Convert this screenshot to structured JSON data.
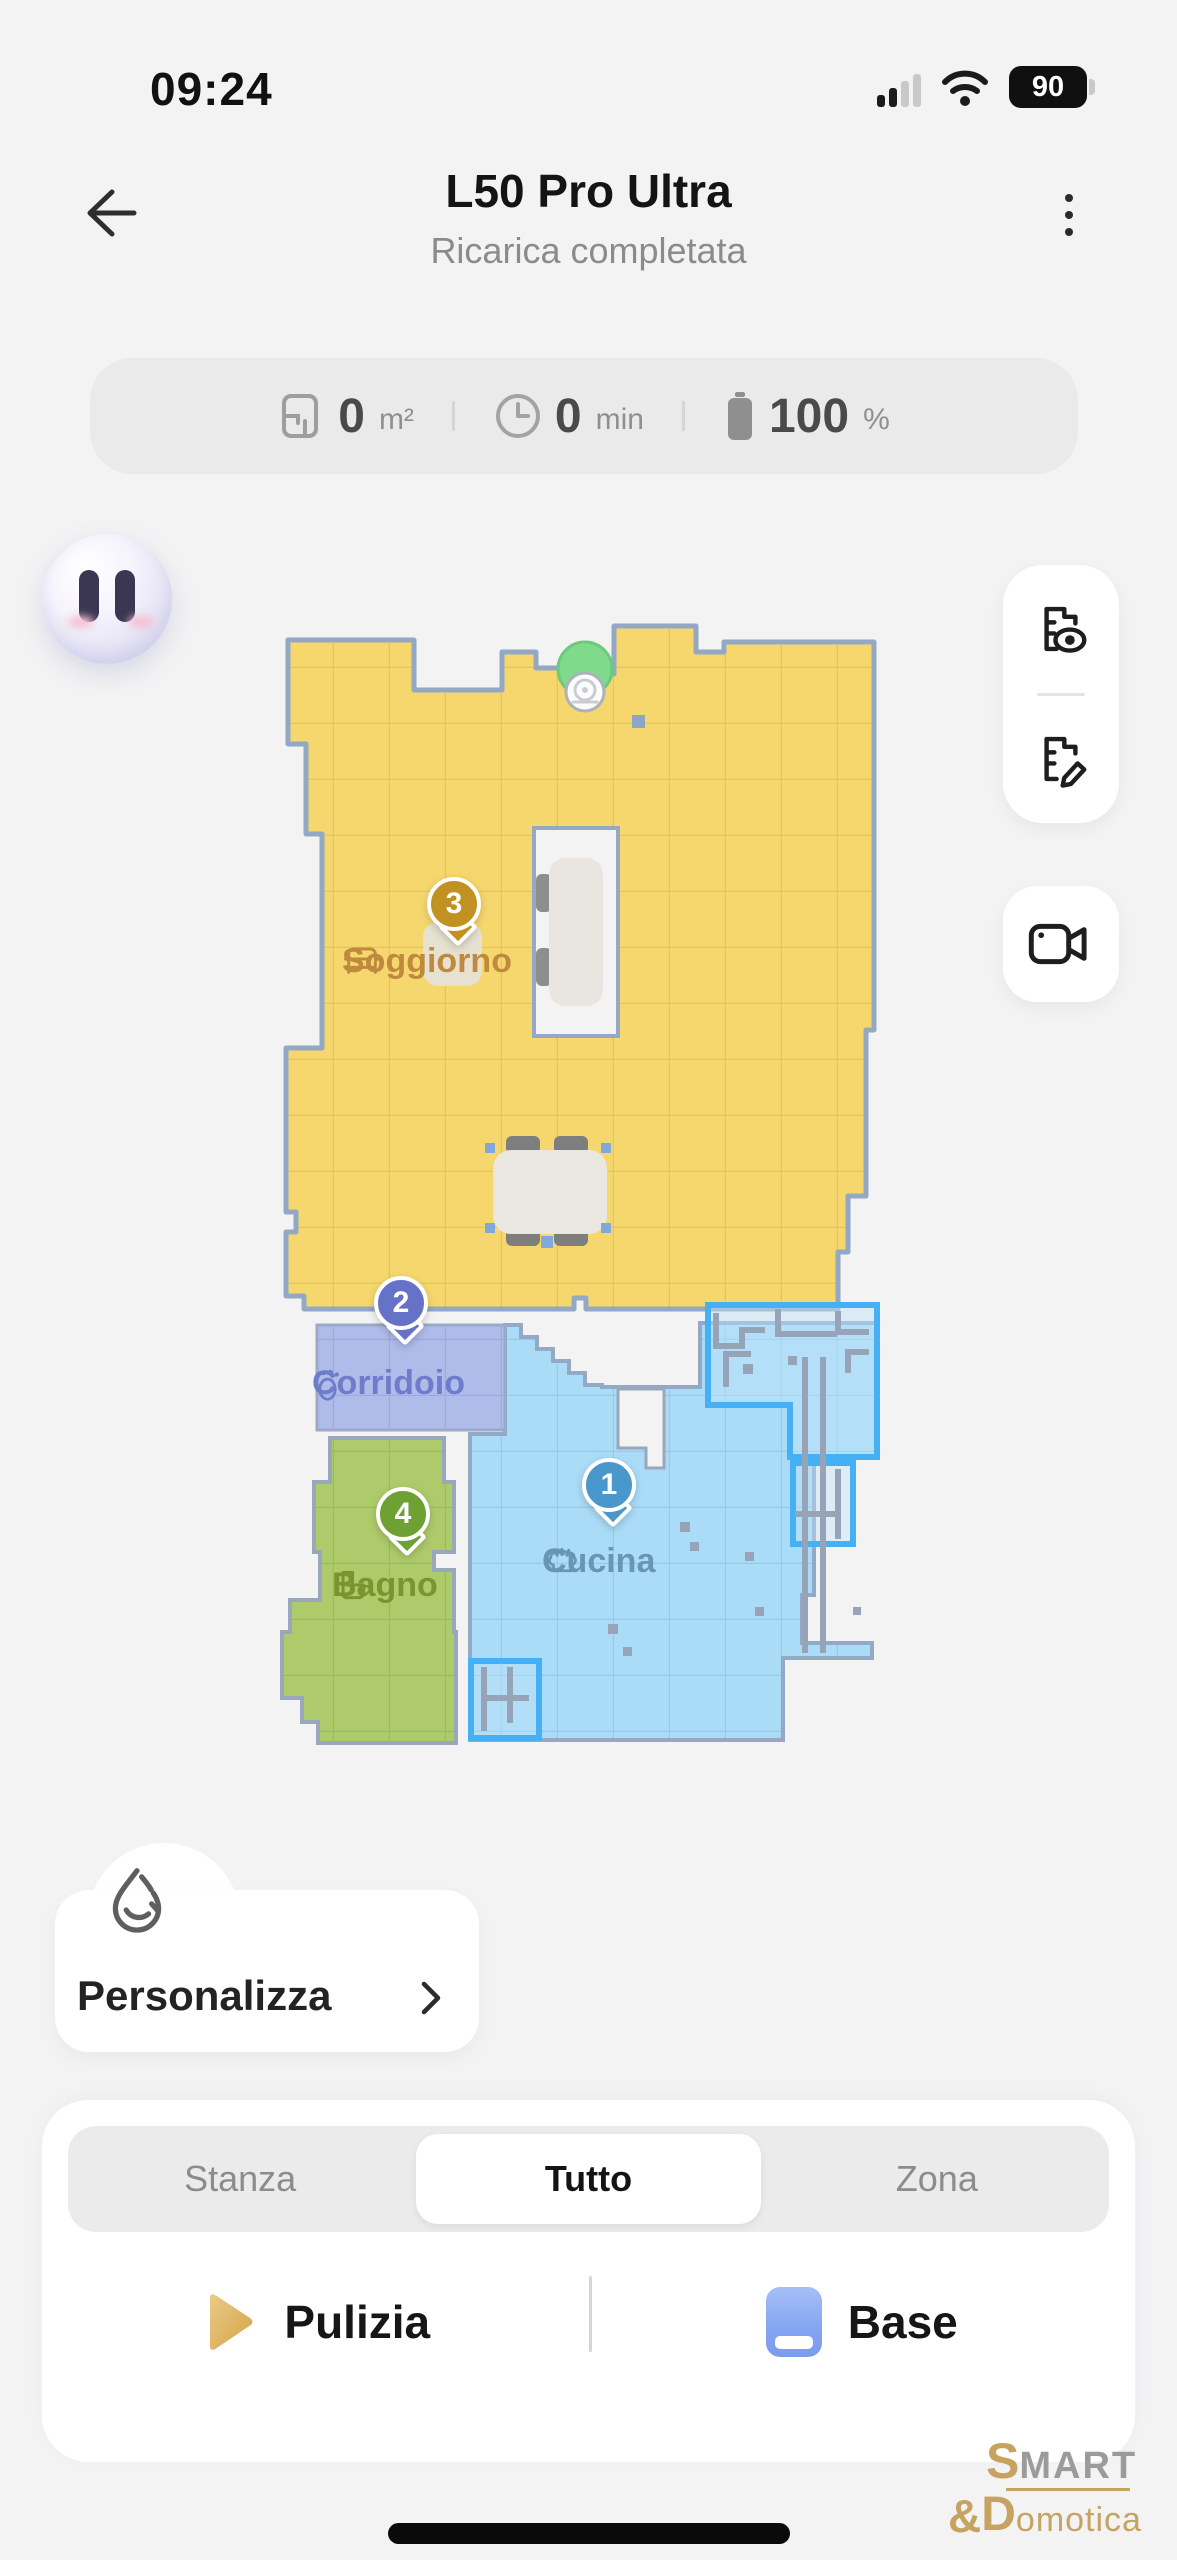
{
  "status_bar": {
    "time": "09:24",
    "battery_percent": "90"
  },
  "header": {
    "title": "L50 Pro Ultra",
    "subtitle": "Ricarica completata"
  },
  "stats": {
    "area": {
      "value": "0",
      "unit": "m²"
    },
    "time": {
      "value": "0",
      "unit": "min"
    },
    "battery": {
      "value": "100",
      "unit": "%"
    }
  },
  "map": {
    "rooms": [
      {
        "name": "Cucina",
        "pin": "1",
        "pin_color": "#4A97CC",
        "label_color": "#6695B5",
        "fill": "#ABDCF7",
        "icon": "chef-hat-icon"
      },
      {
        "name": "Corridoio",
        "pin": "2",
        "pin_color": "#6671C8",
        "label_color": "#6D7CCB",
        "fill": "#AFBCEA",
        "icon": "footprints-icon"
      },
      {
        "name": "Soggiorno",
        "pin": "3",
        "pin_color": "#C19222",
        "label_color": "#C08A3E",
        "fill": "#F6D76D",
        "icon": "sofa-icon"
      },
      {
        "name": "Bagno",
        "pin": "4",
        "pin_color": "#6FA033",
        "label_color": "#7A942F",
        "fill": "#AECB6B",
        "icon": "toilet-icon"
      }
    ],
    "wall_color": "#93A9C6",
    "obstacle_color": "#45B0F4",
    "dock_color": "#7FDA8C",
    "robot_icon": "robot-vacuum"
  },
  "side_tools": {
    "map_view_icon": "map-eye-icon",
    "map_edit_icon": "map-edit-icon",
    "camera_icon": "video-camera-icon"
  },
  "personalizza": {
    "label": "Personalizza"
  },
  "bottom_panel": {
    "tabs": [
      {
        "label": "Stanza",
        "selected": false
      },
      {
        "label": "Tutto",
        "selected": true
      },
      {
        "label": "Zona",
        "selected": false
      }
    ],
    "actions": {
      "clean_label": "Pulizia",
      "dock_label": "Base"
    }
  },
  "watermark": {
    "line1_accent": "S",
    "line1_rest": "MART",
    "amp": "&",
    "line2_accent": "D",
    "line2_rest": "omotica"
  }
}
